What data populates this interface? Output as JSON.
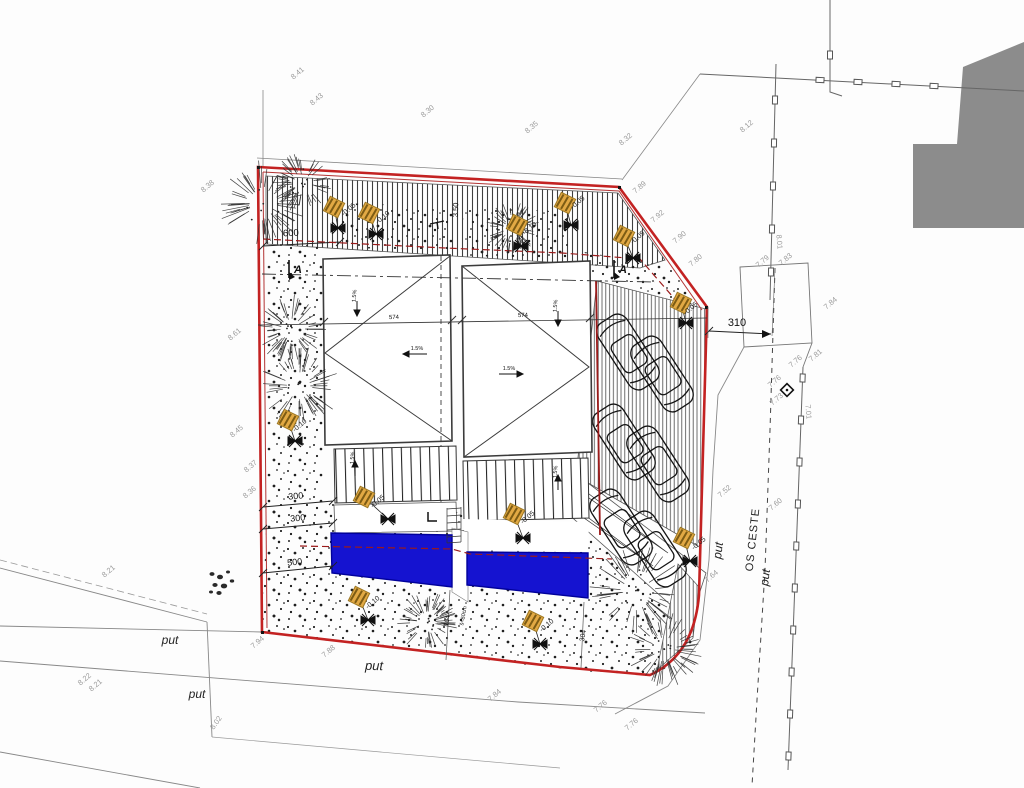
{
  "drawing": {
    "kind": "architectural site plan",
    "parcel_outline": "red",
    "features": [
      "two flat-roof buildings",
      "two swimming pools",
      "six parking stalls",
      "timber deck paving",
      "gravel planting strips",
      "garden lamps with level tags"
    ]
  },
  "colors": {
    "boundary": "#c32222",
    "pool": "#1513d0",
    "neighbor_building": "#8c8c8c",
    "lamp": "#e2a944",
    "cable": "#9b1b1b"
  },
  "road_labels": [
    {
      "text": "put",
      "x": 170,
      "y": 644,
      "rot": 0,
      "size": 12
    },
    {
      "text": "put",
      "x": 197,
      "y": 698,
      "rot": 0,
      "size": 12
    },
    {
      "text": "put",
      "x": 374,
      "y": 670,
      "rot": 1,
      "size": 13
    },
    {
      "text": "put",
      "x": 722,
      "y": 551,
      "rot": -83,
      "size": 12
    },
    {
      "text": "put",
      "x": 769,
      "y": 578,
      "rot": -83,
      "size": 12
    },
    {
      "text": "OS CESTE",
      "x": 756,
      "y": 540,
      "rot": -84,
      "size": 11
    }
  ],
  "elevations": [
    {
      "text": "8.41",
      "x": 299,
      "y": 75,
      "rot": -40
    },
    {
      "text": "8.43",
      "x": 318,
      "y": 101,
      "rot": -40
    },
    {
      "text": "8.30",
      "x": 429,
      "y": 113,
      "rot": -40
    },
    {
      "text": "8.35",
      "x": 533,
      "y": 129,
      "rot": -40
    },
    {
      "text": "8.32",
      "x": 627,
      "y": 141,
      "rot": -40
    },
    {
      "text": "8.12",
      "x": 748,
      "y": 128,
      "rot": -40
    },
    {
      "text": "8.38",
      "x": 209,
      "y": 188,
      "rot": -40
    },
    {
      "text": "8.61",
      "x": 236,
      "y": 336,
      "rot": -40
    },
    {
      "text": "8.45",
      "x": 238,
      "y": 433,
      "rot": -40
    },
    {
      "text": "8.37",
      "x": 252,
      "y": 468,
      "rot": -40
    },
    {
      "text": "8.36",
      "x": 251,
      "y": 494,
      "rot": -40
    },
    {
      "text": "8.21",
      "x": 110,
      "y": 573,
      "rot": -40
    },
    {
      "text": "8.22",
      "x": 86,
      "y": 681,
      "rot": -40
    },
    {
      "text": "8.21",
      "x": 97,
      "y": 687,
      "rot": -40
    },
    {
      "text": "8.02",
      "x": 218,
      "y": 724,
      "rot": -55
    },
    {
      "text": "7.94",
      "x": 259,
      "y": 644,
      "rot": -40
    },
    {
      "text": "7.88",
      "x": 330,
      "y": 653,
      "rot": -40
    },
    {
      "text": "7.84",
      "x": 496,
      "y": 697,
      "rot": -40
    },
    {
      "text": "7.76",
      "x": 602,
      "y": 708,
      "rot": -40
    },
    {
      "text": "7.76",
      "x": 633,
      "y": 726,
      "rot": -40
    },
    {
      "text": "7.89",
      "x": 641,
      "y": 189,
      "rot": -40
    },
    {
      "text": "7.92",
      "x": 659,
      "y": 218,
      "rot": -40
    },
    {
      "text": "7.90",
      "x": 681,
      "y": 239,
      "rot": -40
    },
    {
      "text": "7.80",
      "x": 697,
      "y": 262,
      "rot": -40
    },
    {
      "text": "7.79",
      "x": 764,
      "y": 263,
      "rot": -40
    },
    {
      "text": "7.83",
      "x": 787,
      "y": 261,
      "rot": -40
    },
    {
      "text": "8.01",
      "x": 777,
      "y": 242,
      "rot": 85
    },
    {
      "text": "7.84",
      "x": 832,
      "y": 305,
      "rot": -40
    },
    {
      "text": "7.81",
      "x": 817,
      "y": 357,
      "rot": -40
    },
    {
      "text": "7.76",
      "x": 797,
      "y": 363,
      "rot": -40
    },
    {
      "text": "7.76",
      "x": 776,
      "y": 383,
      "rot": -40
    },
    {
      "text": "7.73",
      "x": 778,
      "y": 401,
      "rot": -40
    },
    {
      "text": "7.01",
      "x": 806,
      "y": 412,
      "rot": 85
    },
    {
      "text": "7.52",
      "x": 726,
      "y": 493,
      "rot": -40
    },
    {
      "text": "7.60",
      "x": 777,
      "y": 506,
      "rot": -40
    },
    {
      "text": "7.64",
      "x": 713,
      "y": 578,
      "rot": -40
    }
  ],
  "dimensions": [
    {
      "text": "600",
      "x": 291,
      "y": 236,
      "rot": -3,
      "size": 9.5
    },
    {
      "text": "300",
      "x": 296,
      "y": 499,
      "rot": -5,
      "size": 9
    },
    {
      "text": "300",
      "x": 298,
      "y": 521,
      "rot": -5,
      "size": 9
    },
    {
      "text": "500",
      "x": 295,
      "y": 565,
      "rot": -6,
      "size": 9
    },
    {
      "text": "310",
      "x": 737,
      "y": 326,
      "rot": 0,
      "size": 11
    },
    {
      "text": "574",
      "x": 394,
      "y": 319,
      "rot": -2,
      "size": 6
    },
    {
      "text": "574",
      "x": 523,
      "y": 317,
      "rot": -2,
      "size": 6
    },
    {
      "text": "3.50",
      "x": 458,
      "y": 210,
      "rot": -88,
      "size": 7.5
    },
    {
      "text": "304",
      "x": 585,
      "y": 636,
      "rot": -80,
      "size": 7
    },
    {
      "text": "104",
      "x": 449,
      "y": 621,
      "rot": -80,
      "size": 6.5
    },
    {
      "text": "š=80cm",
      "x": 465,
      "y": 616,
      "rot": -80,
      "size": 5.5
    }
  ],
  "level_markers": [
    {
      "text": "-0.05",
      "x": 350,
      "y": 211,
      "rot": -40
    },
    {
      "text": "-0.10",
      "x": 384,
      "y": 219,
      "rot": -40
    },
    {
      "text": "-0.10",
      "x": 531,
      "y": 230,
      "rot": -40
    },
    {
      "text": "-0.05",
      "x": 579,
      "y": 204,
      "rot": -40
    },
    {
      "text": "-0.05",
      "x": 639,
      "y": 239,
      "rot": -40
    },
    {
      "text": "-0.05",
      "x": 692,
      "y": 310,
      "rot": -40
    },
    {
      "text": "-0.05",
      "x": 700,
      "y": 545,
      "rot": -40
    },
    {
      "text": "-0.10",
      "x": 301,
      "y": 427,
      "rot": -40
    },
    {
      "text": "-0.05",
      "x": 379,
      "y": 503,
      "rot": -40
    },
    {
      "text": "-0.05",
      "x": 529,
      "y": 519,
      "rot": -40
    },
    {
      "text": "-0.10",
      "x": 374,
      "y": 604,
      "rot": -40
    },
    {
      "text": "-0.10",
      "x": 548,
      "y": 627,
      "rot": -40
    }
  ],
  "slopes": [
    {
      "text": "1.5%",
      "x": 356,
      "y": 296,
      "rot": -85,
      "dir": "down"
    },
    {
      "text": "1.5%",
      "x": 417,
      "y": 350,
      "rot": 0,
      "dir": "left"
    },
    {
      "text": "1.5%",
      "x": 354,
      "y": 458,
      "rot": -85,
      "dir": "up"
    },
    {
      "text": "1.5%",
      "x": 557,
      "y": 306,
      "rot": -85,
      "dir": "down"
    },
    {
      "text": "1.5%",
      "x": 509,
      "y": 370,
      "rot": 0,
      "dir": "right"
    },
    {
      "text": "1.5%",
      "x": 557,
      "y": 472,
      "rot": -85,
      "dir": "up"
    }
  ],
  "sections": [
    {
      "label": "A",
      "x": 296,
      "y": 273
    },
    {
      "label": "A",
      "x": 621,
      "y": 273
    }
  ]
}
